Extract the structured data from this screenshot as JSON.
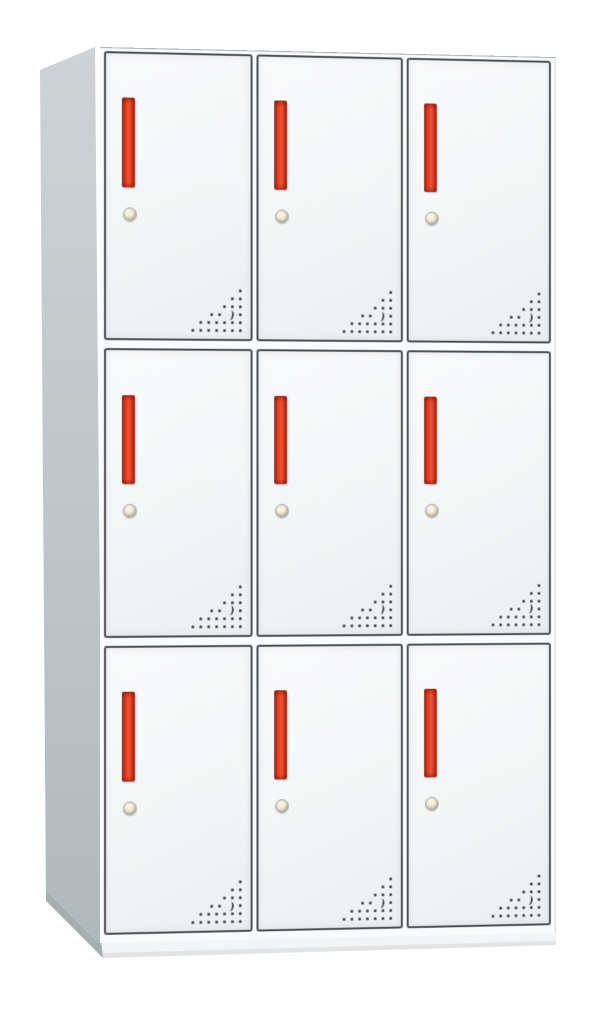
{
  "scene": {
    "type": "product-photo",
    "subject": "white 9-door steel locker cabinet with red vertical handles, round cam locks and triangular vent perforations",
    "background_color": "#ffffff"
  },
  "cabinet": {
    "rows": 3,
    "columns": 3,
    "door_count": 9,
    "door": {
      "handle_type": "vertical-bar-handle",
      "lock_type": "round-cam-lock",
      "vents": {
        "rows_from_top": [
          1,
          2,
          3,
          4,
          6,
          7
        ],
        "crescent": {
          "row_from_top": 4,
          "col_from_right": 2
        }
      }
    },
    "colors": {
      "background": "#ffffff",
      "frame": "#fafbfc",
      "door_face": "#f3f5f6",
      "door_face_light": "#f9fafb",
      "door_face_dark": "#eceff1",
      "door_border": "#4a4f54",
      "face_edge": "#aab0b4",
      "side_panel": "#c0c8cb",
      "side_panel_top": "#cdd3d6",
      "side_panel_bottom": "#b0b8bc",
      "side_panel_shadow": "#a3abaf",
      "base": "#f3f4f5",
      "base_edge": "#d9dcde",
      "handle_core": "#ee4f2f",
      "handle_mid": "#cf3119",
      "handle_edge": "#8e2212",
      "keyhole_ring": "#aab1b5",
      "keyhole_center": "#e7dcc2",
      "vent_dot": "#3c4146"
    }
  }
}
